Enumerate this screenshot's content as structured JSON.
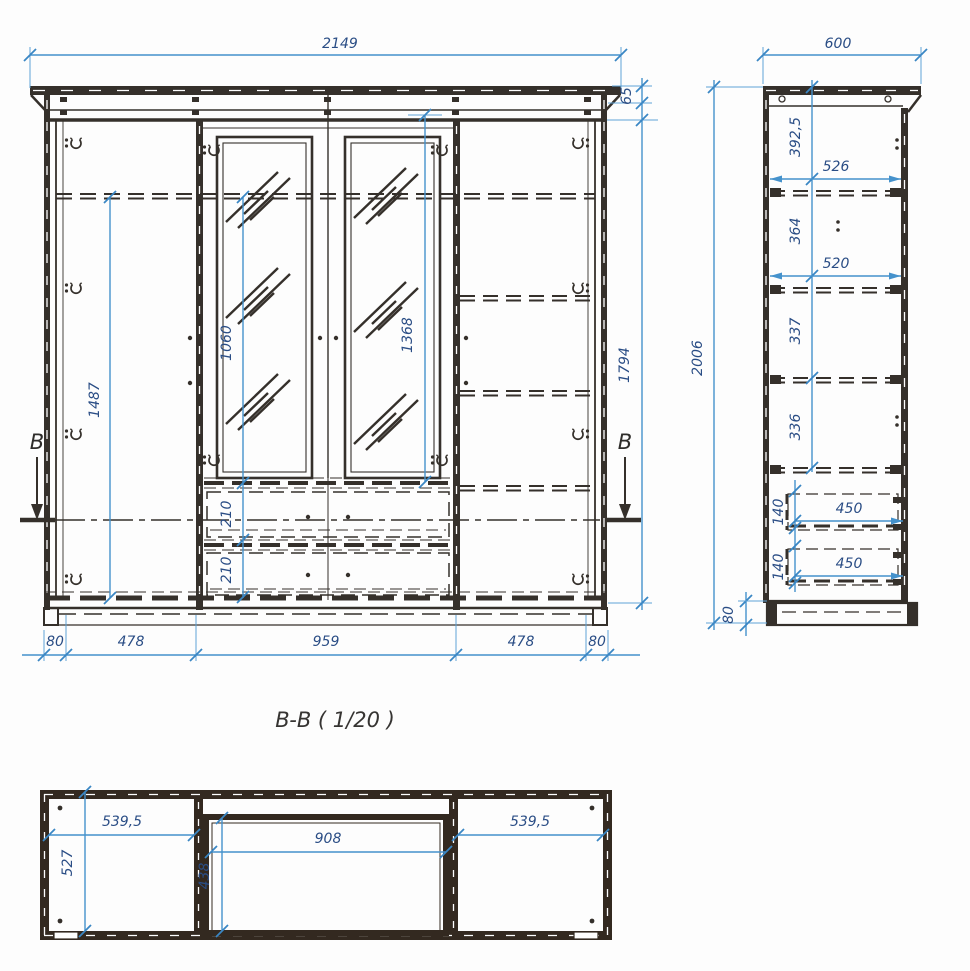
{
  "colors": {
    "drawing_line": "#35302b",
    "section_wall": "#332920",
    "dimension_line": "#4592cc",
    "dimension_text": "#2a4d85",
    "background": "#fdfdfd"
  },
  "front_view": {
    "section_marker_left": "B",
    "section_marker_right": "B",
    "dims": {
      "total_width": "2149",
      "cornice_height": "65",
      "left_interior_height": "1487",
      "mirror_door_height": "1060",
      "center_opening_height": "1368",
      "right_side_height": "1794",
      "drawer_heights": [
        "210",
        "210"
      ],
      "bottom_chain": [
        "80",
        "478",
        "959",
        "478",
        "80"
      ]
    }
  },
  "side_view": {
    "dims": {
      "total_depth": "600",
      "total_height": "2006",
      "segments": [
        "392,5",
        "364",
        "337",
        "336"
      ],
      "shelf_depths": [
        "526",
        "520"
      ],
      "drawer_heights": [
        "140",
        "140"
      ],
      "drawer_depths": [
        "450",
        "450"
      ],
      "plinth_height": "80"
    }
  },
  "section_view": {
    "title": "B-B ( 1/20 )",
    "dims": {
      "left_width": "539,5",
      "center_width": "908",
      "right_width": "539,5",
      "left_depth": "527",
      "center_depth": "438"
    }
  }
}
